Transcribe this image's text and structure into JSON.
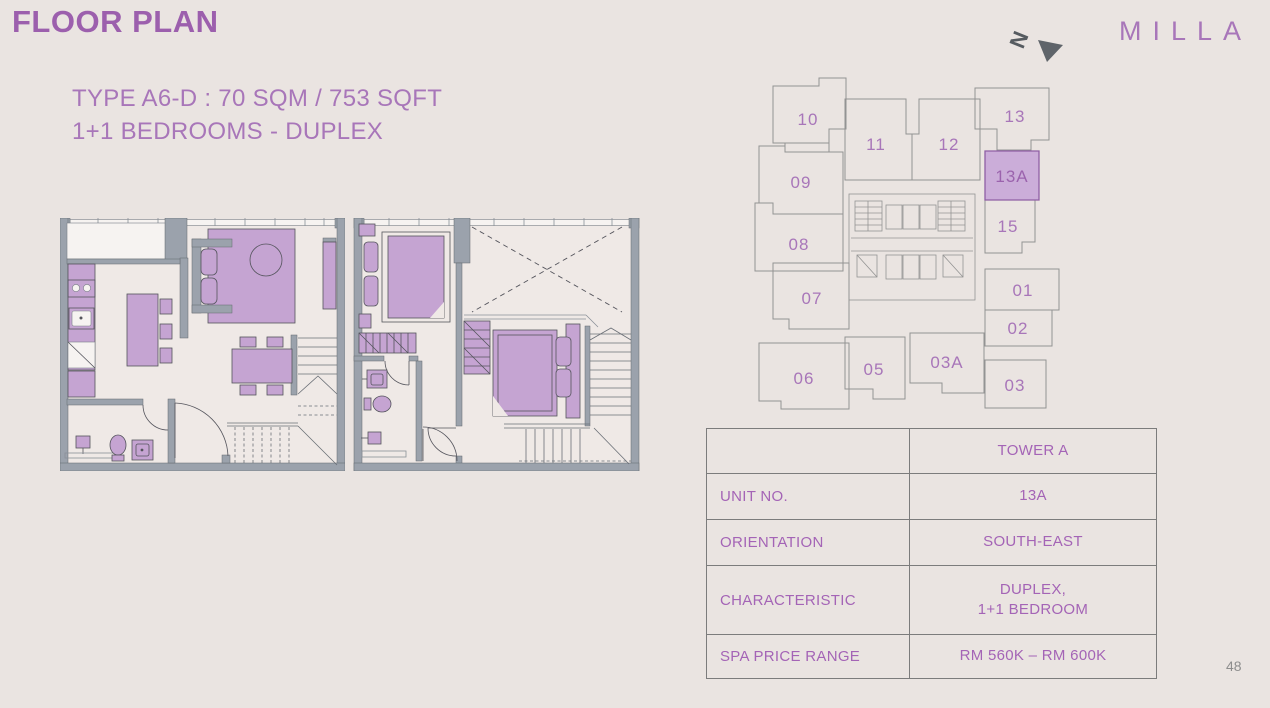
{
  "slide": {
    "title": "FLOOR PLAN",
    "subtitle_line1": "TYPE A6-D : 70 SQM / 753 SQFT",
    "subtitle_line2": "1+1 BEDROOMS - DUPLEX",
    "brand": "MILLA",
    "north_label": "N",
    "page_number": "48"
  },
  "key_plan": {
    "highlighted_unit": "13A",
    "units": [
      "10",
      "11",
      "12",
      "13",
      "09",
      "13A",
      "08",
      "15",
      "07",
      "01",
      "02",
      "06",
      "05",
      "03A",
      "03"
    ]
  },
  "info_table": {
    "rows": [
      {
        "label": "",
        "value": "TOWER A"
      },
      {
        "label": "UNIT NO.",
        "value": "13A"
      },
      {
        "label": "ORIENTATION",
        "value": "SOUTH-EAST"
      },
      {
        "label": "CHARACTERISTIC",
        "value": "DUPLEX,\n1+1 BEDROOM"
      },
      {
        "label": "SPA PRICE RANGE",
        "value": "RM 560K – RM 600K"
      }
    ]
  },
  "colors": {
    "background": "#eae4e1",
    "accent_purple": "#9c5fad",
    "text_purple": "#a876b9",
    "table_text": "#a464b6",
    "table_border": "#7c7c7c",
    "furniture_purple": "#c5a4d2",
    "wall_gray": "#9ba2ac",
    "highlight_unit_fill": "#cbadd9"
  }
}
